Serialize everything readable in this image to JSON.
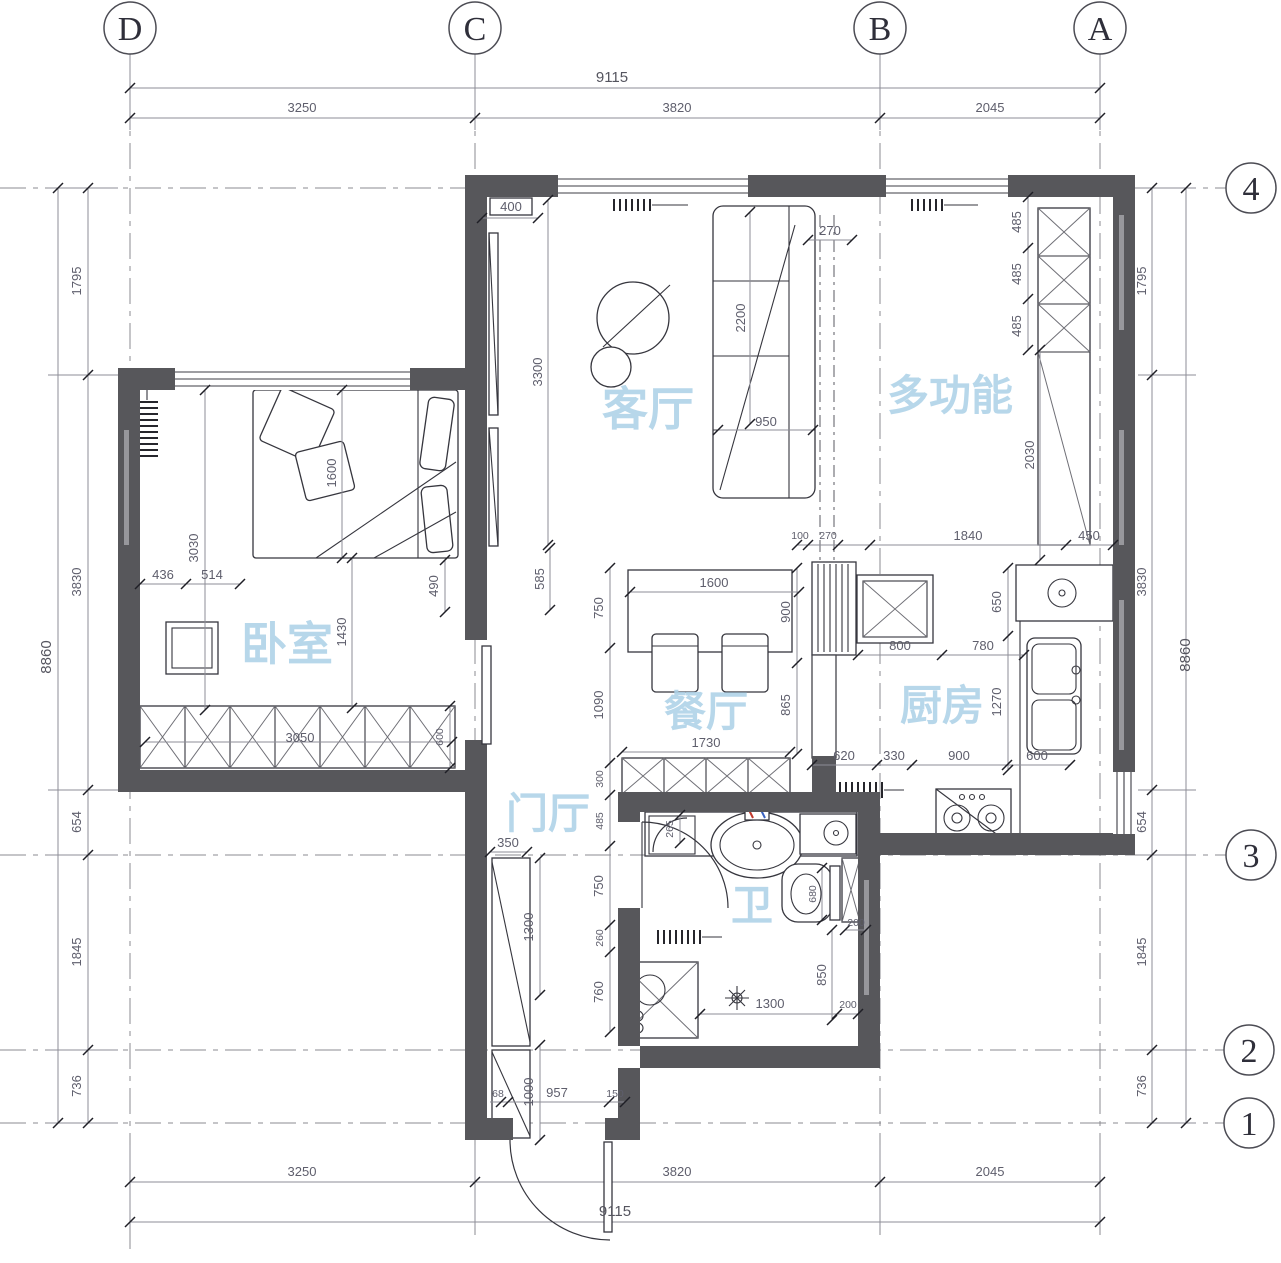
{
  "grid": {
    "cols": [
      "D",
      "C",
      "B",
      "A"
    ],
    "rows": [
      "4",
      "3",
      "2",
      "1"
    ]
  },
  "rooms": {
    "living": "客厅",
    "multi": "多功能",
    "bedroom": "卧室",
    "dining": "餐厅",
    "kitchen": "厨房",
    "hall": "门厅",
    "bath": "卫"
  },
  "chains": {
    "top": {
      "total": "9115",
      "segments": [
        "3250",
        "3820",
        "2045"
      ]
    },
    "bottom": {
      "total": "9115",
      "segments": [
        "3250",
        "3820",
        "2045"
      ]
    },
    "left": {
      "total": "8860",
      "segments": [
        "1795",
        "3830",
        "654",
        "1845",
        "736"
      ]
    },
    "right": {
      "total": "8860",
      "segments": [
        "1795",
        "3830",
        "654",
        "1845",
        "736"
      ]
    }
  },
  "interior": {
    "living_tv": "400",
    "sofa_270": "270",
    "sofa_2200": "2200",
    "sofa_950": "950",
    "living_3300": "3300",
    "multi_485a": "485",
    "multi_485b": "485",
    "multi_485c": "485",
    "multi_2030": "2030",
    "multi_1840": "1840",
    "multi_450": "450",
    "stub_100": "100",
    "stub_270": "270",
    "din_1600": "1600",
    "din_900": "900",
    "din_750": "750",
    "din_1090": "1090",
    "din_865": "865",
    "din_1730": "1730",
    "din_300": "300",
    "din_485": "485",
    "kit_800": "800",
    "kit_780": "780",
    "kit_650": "650",
    "kit_1270": "1270",
    "kit_620": "620",
    "kit_330": "330",
    "kit_900": "900",
    "kit_600": "600",
    "bed_436": "436",
    "bed_514": "514",
    "bed_3030": "3030",
    "bed_1600": "1600",
    "bed_1430": "1430",
    "bed_490": "490",
    "bed_585": "585",
    "bed_3050": "3050",
    "bed_600": "600",
    "hall_350": "350",
    "hall_1300": "1300",
    "hall_1000": "1000",
    "ent_68": "68",
    "ent_957": "957",
    "ent_150": "150",
    "bath_750": "750",
    "bath_260": "260",
    "bath_760": "760",
    "bath_265": "265",
    "bath_680": "680",
    "bath_200a": "200",
    "bath_850": "850",
    "bath_1300": "1300",
    "bath_200b": "200"
  },
  "colors": {
    "wall": "#57575b",
    "room_label": "#aed2e8",
    "dim_text": "#5e5e6c",
    "dim_900_accent": "#b55e2c",
    "dim_600_accent": "#5a7ba4",
    "dim_950_accent": "#8a4a38"
  }
}
